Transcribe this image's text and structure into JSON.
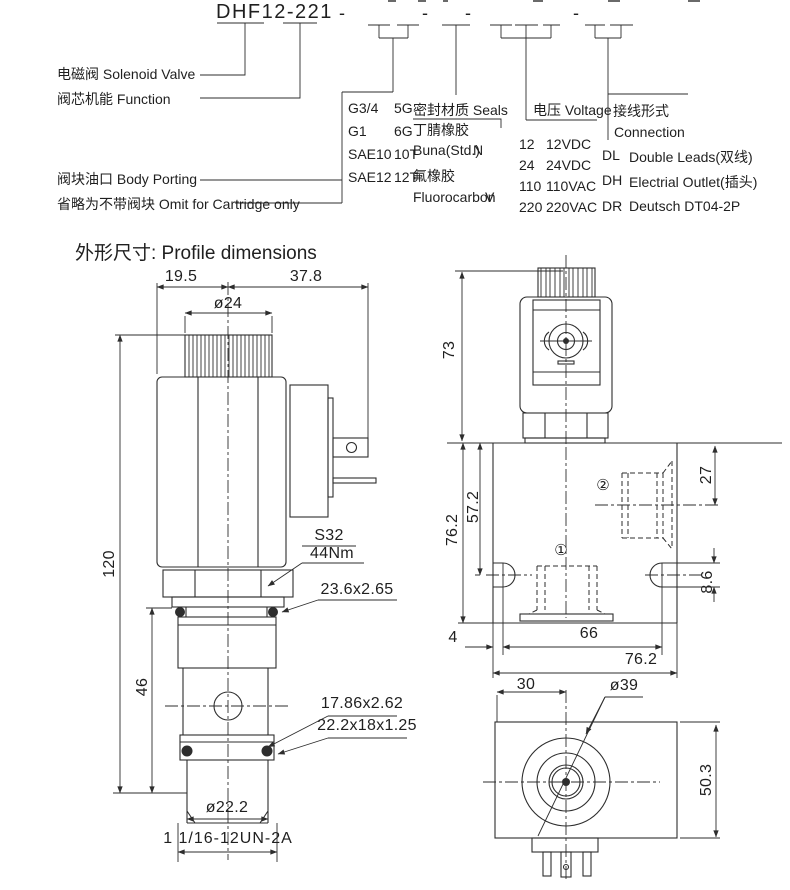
{
  "colors": {
    "line": "#2d2d2d",
    "text": "#1f1f1f",
    "bg": "#ffffff"
  },
  "model_code": {
    "title": "DHF12-221",
    "dash": "-",
    "leaders": {
      "solenoid_valve": "电磁阀 Solenoid Valve",
      "function": "阀芯机能 Function",
      "body_porting": "阀块油口 Body Porting",
      "omit_note": "省略为不带阀块 Omit for Cartridge only"
    },
    "porting": {
      "options": [
        {
          "size": "G3/4",
          "code": "5G"
        },
        {
          "size": "G1",
          "code": "6G"
        },
        {
          "size": "SAE10",
          "code": "10T"
        },
        {
          "size": "SAE12",
          "code": "12T"
        }
      ]
    },
    "seals": {
      "header": "密封材质 Seals",
      "options": [
        {
          "cn": "丁腈橡胶",
          "en": "Buna(Std.)",
          "code": "N"
        },
        {
          "cn": "氟橡胶",
          "en": "Fluorocarbon",
          "code": "V"
        }
      ]
    },
    "voltage": {
      "header": "电压 Voltage",
      "options": [
        {
          "code": "12",
          "label": "12VDC"
        },
        {
          "code": "24",
          "label": "24VDC"
        },
        {
          "code": "110",
          "label": "110VAC"
        },
        {
          "code": "220",
          "label": "220VAC"
        }
      ]
    },
    "connection": {
      "header_cn": "接线形式",
      "header_en": "Connection",
      "options": [
        {
          "code": "DL",
          "label": "Double Leads(双线)"
        },
        {
          "code": "DH",
          "label": "Electrial Outlet(插头)"
        },
        {
          "code": "DR",
          "label": "Deutsch DT04-2P"
        }
      ]
    }
  },
  "section": {
    "heading": "外形尺寸: Profile dimensions"
  },
  "dims": {
    "top_left": "19.5",
    "top_right": "37.8",
    "coil_dia": "ø24",
    "overall_h": "120",
    "cartridge_h": "46",
    "hex_size": "S32",
    "torque": "44Nm",
    "oring_top": "23.6x2.65",
    "oring_low": "17.86x2.62",
    "backup_ring": "22.2x18x1.25",
    "thread_dia": "ø22.2",
    "thread_spec": "1 1/16-12UN-2A",
    "conn_h": "73",
    "block_side": "76.2",
    "port_depth": "57.2",
    "port2_center": "27",
    "slot_h": "8.6",
    "edge_gap": "4",
    "slot_span": "66",
    "block_w": "76.2",
    "coil_center": "30",
    "coil_dia_top": "ø39",
    "block_depth": "50.3",
    "port1_mark": "①",
    "port2_mark": "②"
  }
}
